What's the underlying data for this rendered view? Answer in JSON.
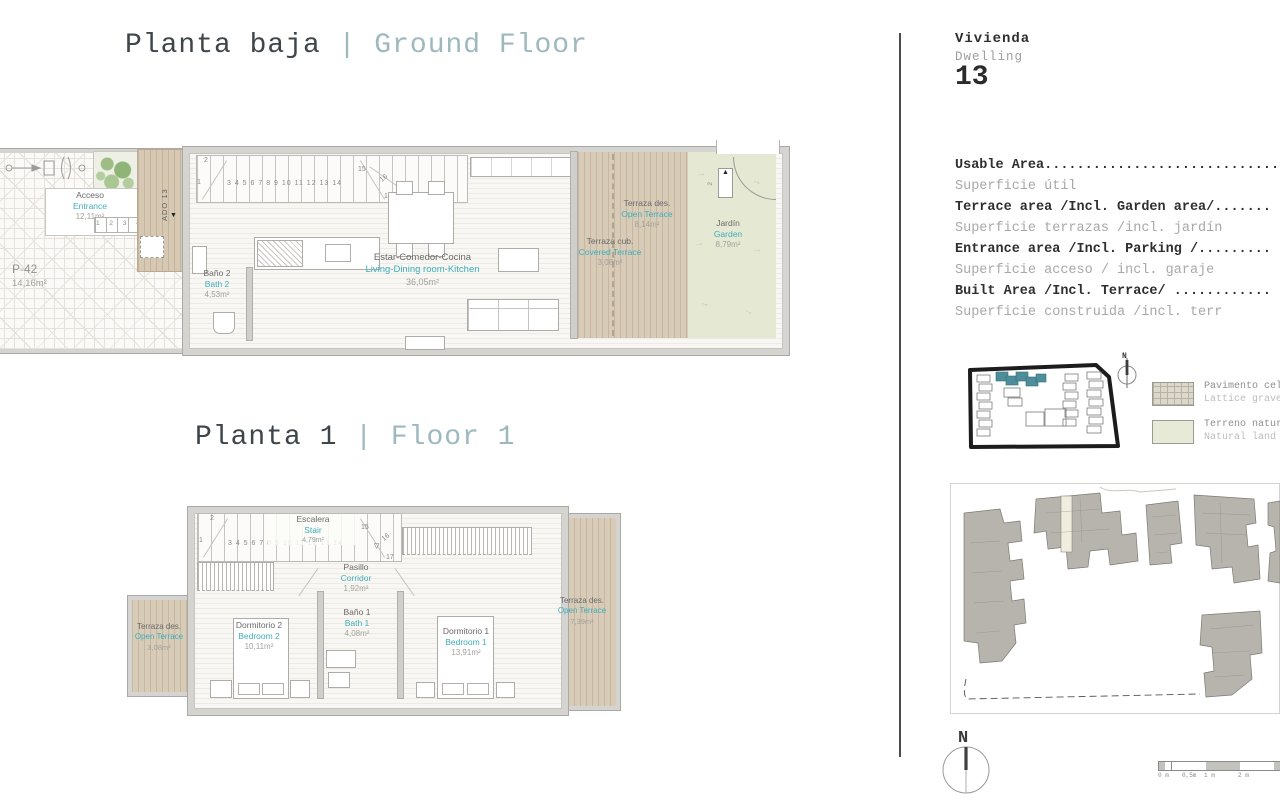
{
  "icons": {
    "down_arrow": "▼",
    "up_arrow": "▲",
    "stair_down": "▽",
    "flow_arrow": "→"
  },
  "ground_floor": {
    "title_es": "Planta baja",
    "title_sep": "|",
    "title_en": "Ground Floor",
    "parking": {
      "name": "P-42",
      "area": "14,16m²"
    },
    "entrance": {
      "es": "Acceso",
      "en": "Entrance",
      "area": "12,11m²"
    },
    "entrance_steps": "1 2 3 4",
    "ado_label": "ADO 13",
    "stair": {
      "n1": "1",
      "n2": "2",
      "treads": "3 4 5 6 7 8 9 10 11 12 13 14",
      "n15": "15",
      "n16": "16",
      "n17": "17"
    },
    "bath2": {
      "es": "Baño 2",
      "en": "Bath 2",
      "area": "4,53m²"
    },
    "living": {
      "es": "Estar-Comedor-Cocina",
      "en": "Living-Dining room-Kitchen",
      "area": "36,05m²"
    },
    "covered_terrace": {
      "es": "Terraza cub.",
      "en": "Covered Terrace",
      "area": "3,08m²"
    },
    "open_terrace": {
      "es": "Terraza des.",
      "en": "Open Terrace",
      "area": "8,14m²"
    },
    "garden": {
      "es": "Jardín",
      "en": "Garden",
      "area": "8,79m²"
    },
    "door_step_number": "2"
  },
  "floor1": {
    "title_es": "Planta 1",
    "title_sep": "|",
    "title_en": "Floor 1",
    "stair": {
      "es": "Escalera",
      "en": "Stair",
      "area": "4,79m²",
      "n1": "1",
      "n2": "2",
      "treads": "3 4 5 6 7 8 9 10 11 12 13 14",
      "n15": "15",
      "n16": "16",
      "n17": "17"
    },
    "corridor": {
      "es": "Pasillo",
      "en": "Corridor",
      "area": "1,92m²"
    },
    "bath1": {
      "es": "Baño 1",
      "en": "Bath 1",
      "area": "4,08m²"
    },
    "bedroom2": {
      "es": "Dormitorio 2",
      "en": "Bedroom 2",
      "area": "10,11m²"
    },
    "bedroom1": {
      "es": "Dormitorio 1",
      "en": "Bedroom 1",
      "area": "13,91m²"
    },
    "terrace_left": {
      "es": "Terraza des.",
      "en": "Open Terrace",
      "area": "3,08m²"
    },
    "terrace_right": {
      "es": "Terraza des.",
      "en": "Open Terrace",
      "area": "7,39m²"
    }
  },
  "panel": {
    "dwelling_es": "Vivienda",
    "dwelling_en": "Dwelling",
    "dwelling_number": "13",
    "areas": [
      {
        "en": "Usable Area..................................",
        "es": "Superficie útil"
      },
      {
        "en": "Terrace area /Incl. Garden area/.......",
        "es": "Superficie terrazas /incl. jardín"
      },
      {
        "en": "Entrance area /Incl. Parking /.........",
        "es": "Superficie acceso / incl. garaje"
      },
      {
        "en": "Built Area /Incl. Terrace/ ............",
        "es": "Superficie construida /incl. terr"
      }
    ],
    "legend": [
      {
        "es": "Pavimento cel",
        "en": "Lattice grave"
      },
      {
        "es": "Terreno natur",
        "en": "Natural land"
      }
    ],
    "compass_n": "N",
    "scale_labels": [
      "0 m",
      "0,5m",
      "1 m",
      "2 m"
    ]
  },
  "colors": {
    "accent_teal": "#3fadb9",
    "title_muted": "#9db9be",
    "terrace": "#d8ccb9",
    "garden": "#e5e9d4",
    "site_highlight": "#4e8e9a"
  }
}
